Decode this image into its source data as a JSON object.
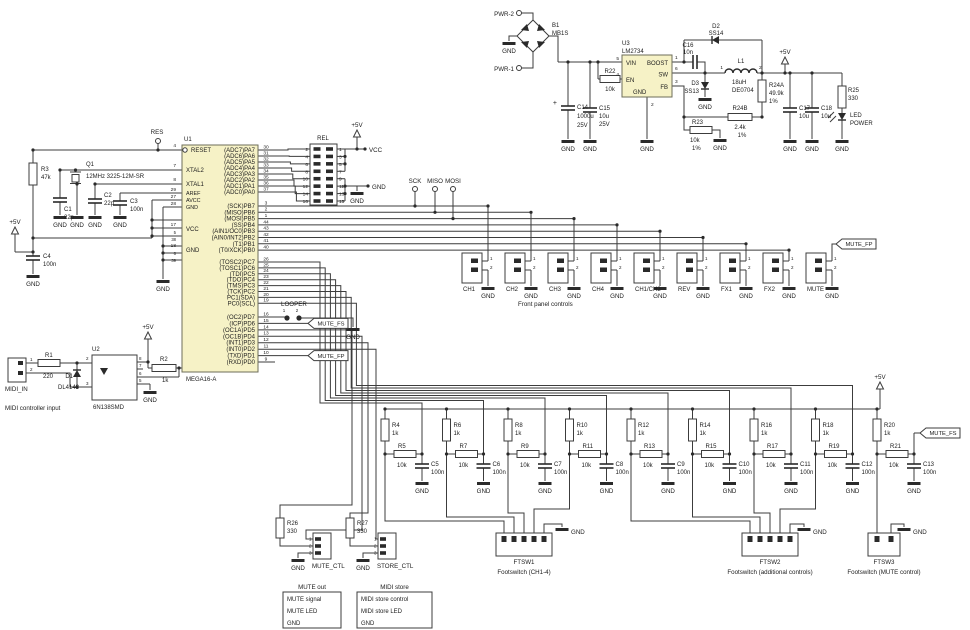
{
  "g": {
    "gnd": "GND",
    "p5v": "+5V",
    "vcc": "VCC"
  },
  "power": {
    "pwr2": "PWR-2",
    "pwr1": "PWR-1",
    "b1": "B1",
    "b1v": "MB1S",
    "plus": "+",
    "c14": "C14",
    "c14a": "1000u",
    "c14b": "25V",
    "c15": "C15",
    "c15a": "10u",
    "c15b": "25V",
    "r22": "R22",
    "r22v": "10k",
    "u3": "U3",
    "u3v": "LM2734",
    "vin": "VIN",
    "en": "EN",
    "gnd": "GND",
    "boost": "BOOST",
    "sw": "SW",
    "fb": "FB",
    "n1": "1",
    "n2": "2",
    "n3": "3",
    "n4": "4",
    "n5": "5",
    "n6": "6",
    "c16": "C16",
    "c16v": "10n",
    "d2": "D2",
    "d2v": "SS14",
    "d3": "D3",
    "d3v": "SS13",
    "l1": "L1",
    "l1v": "18uH",
    "l1p": "DE0704",
    "r24a": "R24A",
    "r24av": "49.9k",
    "r24ap": "1%",
    "r24b": "R24B",
    "r24bv": "2.4k",
    "r24bp": "1%",
    "r23": "R23",
    "r23v": "10k",
    "r23p": "1%",
    "c17": "C17",
    "c17v": "10u",
    "c18": "C18",
    "c18v": "10u",
    "r25": "R25",
    "r25v": "330",
    "led1": "LED",
    "led2": "POWER"
  },
  "left": {
    "res": "RES",
    "r3": "R3",
    "r3v": "47k",
    "q1": "Q1",
    "q1v": "12MHz 3225-12M-SR",
    "c1": "C1",
    "c1v": "22p",
    "c2": "C2",
    "c2v": "22p",
    "c3": "C3",
    "c3v": "100n",
    "c4": "C4",
    "c4v": "100n"
  },
  "mcu": {
    "ref": "U1",
    "part": "MEGA16-A",
    "left": [
      {
        "n": "4",
        "l": "RESET"
      },
      {
        "n": "7",
        "l": "XTAL2"
      },
      {
        "n": "8",
        "l": "XTAL1"
      },
      {
        "n": "29",
        "l": "AREF"
      },
      {
        "n": "27",
        "l": "AVCC"
      },
      {
        "n": "28",
        "l": "GND"
      },
      {
        "n": "17",
        "n2": "5",
        "n3": "38",
        "l": "VCC"
      },
      {
        "n": "18",
        "n2": "6",
        "n3": "39",
        "l": "GND"
      }
    ],
    "pa": [
      {
        "n": "30",
        "l": "(ADC7)PA7"
      },
      {
        "n": "31",
        "l": "(ADC6)PA6"
      },
      {
        "n": "32",
        "l": "(ADC5)PA5"
      },
      {
        "n": "33",
        "l": "(ADC4)PA4"
      },
      {
        "n": "34",
        "l": "(ADC3)PA3"
      },
      {
        "n": "35",
        "l": "(ADC2)PA2"
      },
      {
        "n": "36",
        "l": "(ADC1)PA1"
      },
      {
        "n": "37",
        "l": "(ADC0)PA0"
      }
    ],
    "pb": [
      {
        "n": "3",
        "l": "(SCK)PB7"
      },
      {
        "n": "2",
        "l": "(MISO)PB6"
      },
      {
        "n": "1",
        "l": "(MOSI)PB5"
      },
      {
        "n": "44",
        "l": "(SS)PB4"
      },
      {
        "n": "43",
        "l": "(AIN1/OC0)PB3"
      },
      {
        "n": "42",
        "l": "(AIN0/INT2)PB2"
      },
      {
        "n": "41",
        "l": "(T1)PB1"
      },
      {
        "n": "40",
        "l": "(T0/XCK)PB0"
      }
    ],
    "pc": [
      {
        "n": "26",
        "l": "(TOSC2)PC7"
      },
      {
        "n": "25",
        "l": "(TOSC1)PC6"
      },
      {
        "n": "24",
        "l": "(TDI)PC5"
      },
      {
        "n": "23",
        "l": "(TDO)PC4"
      },
      {
        "n": "22",
        "l": "(TMS)PC3"
      },
      {
        "n": "21",
        "l": "(TCK)PC2"
      },
      {
        "n": "20",
        "l": "PC1(SDA)"
      },
      {
        "n": "19",
        "l": "PC0(SCL)"
      }
    ],
    "pd": [
      {
        "n": "16",
        "l": "(OC2)PD7"
      },
      {
        "n": "15",
        "l": "(ICP)PD6"
      },
      {
        "n": "14",
        "l": "(OC1A)PD5"
      },
      {
        "n": "13",
        "l": "(OC1B)PD4"
      },
      {
        "n": "12",
        "l": "(INT1)PD3"
      },
      {
        "n": "11",
        "l": "(INT0)PD2"
      },
      {
        "n": "10",
        "l": "(TXD)PD1"
      },
      {
        "n": "9",
        "l": "(RXD)PD0"
      }
    ]
  },
  "rel": {
    "ref": "REL",
    "ln": [
      "2",
      "4",
      "6",
      "8",
      "10",
      "12",
      "14",
      "16"
    ],
    "rn": [
      "1",
      "3",
      "5",
      "7",
      "9",
      "11",
      "13",
      "15"
    ]
  },
  "spi": [
    "SCK",
    "MISO",
    "MOSI"
  ],
  "flags": {
    "looper": "LOOPER",
    "fs": "MUTE_FS",
    "fp": "MUTE_FP",
    "n1": "1",
    "n2": "2"
  },
  "midi": {
    "conn": "MIDI_IN",
    "cap": "MIDI controller input",
    "r1": "R1",
    "r1v": "220",
    "d1": "D1",
    "d1v": "DL4148",
    "u2": "U2",
    "u2v": "6N138SMD",
    "r2": "R2",
    "r2v": "1k",
    "pins": [
      "1",
      "2"
    ],
    "lp": [
      "2",
      "3"
    ],
    "rp": [
      "8",
      "7",
      "6",
      "5"
    ]
  },
  "fp": {
    "caption": "Front panel controls",
    "n1": "1",
    "n2": "2",
    "items": [
      "CH1",
      "CH2",
      "CH3",
      "CH4",
      "CH1/CH2",
      "REV",
      "FX1",
      "FX2",
      "MUTE"
    ]
  },
  "net": {
    "cells": [
      {
        "r": "R4",
        "rv": "1k",
        "s": "R5",
        "sv": "10k",
        "c": "C5",
        "cv": "100n"
      },
      {
        "r": "R6",
        "rv": "1k",
        "s": "R7",
        "sv": "10k",
        "c": "C6",
        "cv": "100n"
      },
      {
        "r": "R8",
        "rv": "1k",
        "s": "R9",
        "sv": "10k",
        "c": "C7",
        "cv": "100n"
      },
      {
        "r": "R10",
        "rv": "1k",
        "s": "R11",
        "sv": "10k",
        "c": "C8",
        "cv": "100n"
      },
      {
        "r": "R12",
        "rv": "1k",
        "s": "R13",
        "sv": "10k",
        "c": "C9",
        "cv": "100n"
      },
      {
        "r": "R14",
        "rv": "1k",
        "s": "R15",
        "sv": "10k",
        "c": "C10",
        "cv": "100n"
      },
      {
        "r": "R16",
        "rv": "1k",
        "s": "R17",
        "sv": "10k",
        "c": "C11",
        "cv": "100n"
      },
      {
        "r": "R18",
        "rv": "1k",
        "s": "R19",
        "sv": "10k",
        "c": "C12",
        "cv": "100n"
      },
      {
        "r": "R20",
        "rv": "1k",
        "s": "R21",
        "sv": "10k",
        "c": "C13",
        "cv": "100n"
      }
    ]
  },
  "fts": [
    {
      "ref": "FTSW1",
      "cap": "Footswitch (CH1-4)"
    },
    {
      "ref": "FTSW2",
      "cap": "Footswitch (additional controls)"
    },
    {
      "ref": "FTSW3",
      "cap": "Footswitch (MUTE control)"
    }
  ],
  "ctl": {
    "r26": "R26",
    "r26v": "330",
    "r27": "R27",
    "r27v": "330",
    "mute": "MUTE_CTL",
    "store": "STORE_CTL",
    "p1": "1",
    "p2": "2",
    "p3": "3"
  },
  "tables": {
    "mute": {
      "title": "MUTE out",
      "rows": [
        "MUTE signal",
        "MUTE LED",
        "GND"
      ]
    },
    "store": {
      "title": "MIDI store",
      "rows": [
        "MIDI store control",
        "MIDI store LED",
        "GND"
      ]
    }
  },
  "colors": {
    "ic_fill": "#f6f2c6",
    "ic_stroke": "#6e6e5a",
    "wire": "#3c3c3c",
    "ink": "#1c1c1c"
  }
}
